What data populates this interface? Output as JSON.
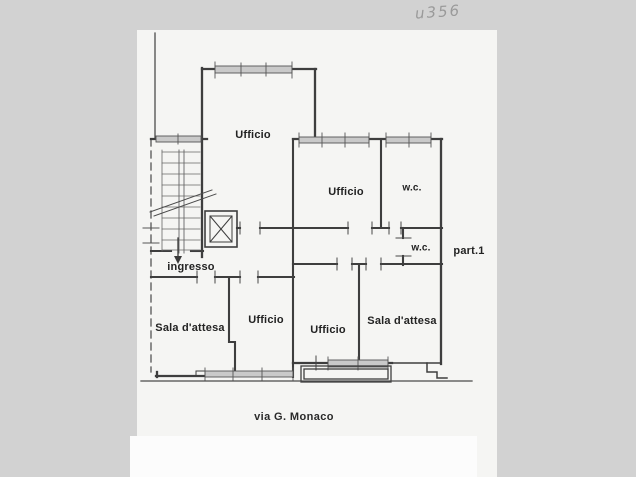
{
  "page": {
    "background_color": "#d2d2d2",
    "paper_color": "#f5f5f3",
    "ink_color": "#3e3e3e"
  },
  "annotation": {
    "text": "u356",
    "color": "#9a9a9a"
  },
  "plan": {
    "rooms": [
      {
        "id": "ufficio-top",
        "label": "Ufficio"
      },
      {
        "id": "ufficio-middle",
        "label": "Ufficio"
      },
      {
        "id": "wc-top",
        "label": "w.c."
      },
      {
        "id": "wc-corridor",
        "label": "w.c."
      },
      {
        "id": "ingresso",
        "label": "ingresso"
      },
      {
        "id": "sala-attesa-left",
        "label": "Sala d'attesa"
      },
      {
        "id": "ufficio-bottom-left",
        "label": "Ufficio"
      },
      {
        "id": "ufficio-bottom-middle",
        "label": "Ufficio"
      },
      {
        "id": "sala-attesa-right",
        "label": "Sala d'attesa"
      }
    ],
    "unit_label": "part.1",
    "street_label": "via G. Monaco",
    "features": [
      "staircase",
      "elevator",
      "entrance-arrow",
      "balcony",
      "windows",
      "dashed-boundary-line",
      "street-line"
    ]
  }
}
